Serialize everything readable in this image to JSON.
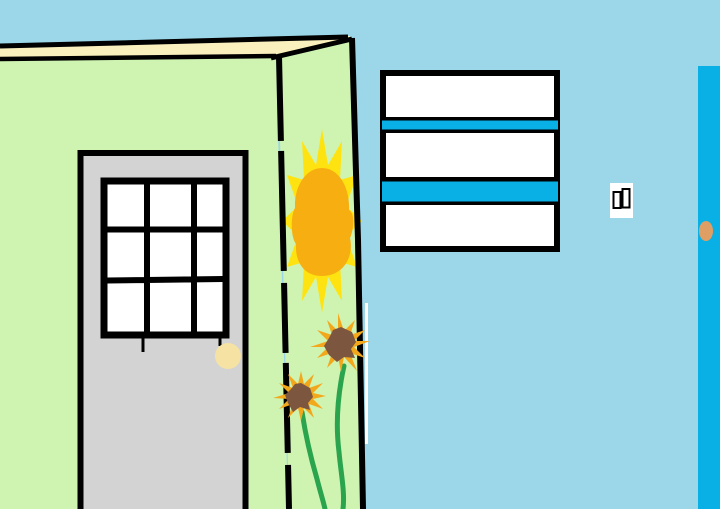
{
  "palette": {
    "sky": "#9bd7e9",
    "wall_green": "#cff4b2",
    "fascia_cream": "#faf0bd",
    "outline_black": "#000000",
    "door_gray": "#d3d3d3",
    "white": "#ffffff",
    "knob_cream": "#f6e3a3",
    "stripe_blue": "#09b0e6",
    "blue_door": "#09b0e6",
    "knob_tan": "#df9e63",
    "sun_ray_yellow": "#ffe311",
    "sun_core_gold": "#f7ae10",
    "petal_gold": "#f3a81c",
    "flower_brown": "#7d5640",
    "stem_green": "#2ba44e"
  },
  "objects": {
    "door_window": {
      "rows": 3,
      "cols": 3,
      "panes": 9
    },
    "striped_sign": {
      "blue_stripes": 2,
      "white_bands": 3
    },
    "light_switch": {
      "toggles": 2
    },
    "sunflowers": {
      "count": 2
    },
    "doors": {
      "count": 3
    }
  }
}
